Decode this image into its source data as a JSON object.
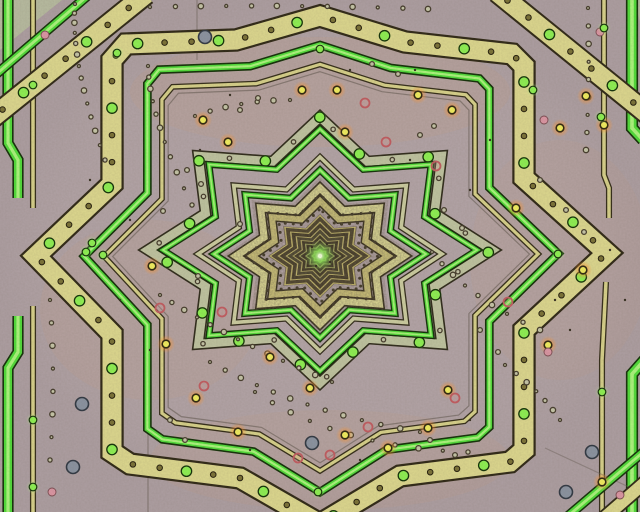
{
  "meta": {
    "title": "Kaleidoscopic fractal star pattern",
    "kind": "abstract-fractal-image"
  },
  "canvas": {
    "width": 640,
    "height": 512,
    "background": "#b2a3a6"
  },
  "palette": {
    "mauve": "#b2a3a6",
    "mauve_light": "#bcacae",
    "sage": "#b8bfa0",
    "band_yellow": "#ddd88e",
    "band_yellow_pale": "#e3e098",
    "band_yellow_deep": "#d2c87a",
    "green_bright": "#4fdd38",
    "green_core": "#abf77c",
    "green_edge": "#123007",
    "dark_edge": "#2e2715",
    "cluster_fill": "#70634f",
    "glow_center": "#f4ffe0",
    "glow_mid": "#8fe857",
    "halo_orange": "#ff9633",
    "dot_yellow": "#f3ef5e",
    "dot_green": "#8df251",
    "ring_red": "#c25b60",
    "pink": "#dc96a4",
    "grey_blue": "#8a93a1",
    "olive": "#7a7136"
  },
  "center": {
    "x": 320,
    "y": 258
  },
  "outer_path": [
    [
      320,
      16
    ],
    [
      405,
      42
    ],
    [
      512,
      54
    ],
    [
      524,
      66
    ],
    [
      524,
      178
    ],
    [
      607,
      253
    ],
    [
      524,
      330
    ],
    [
      524,
      450
    ],
    [
      510,
      462
    ],
    [
      400,
      476
    ],
    [
      320,
      524
    ],
    [
      240,
      478
    ],
    [
      130,
      464
    ],
    [
      112,
      452
    ],
    [
      112,
      334
    ],
    [
      36,
      256
    ],
    [
      112,
      184
    ],
    [
      112,
      60
    ],
    [
      126,
      44
    ],
    [
      236,
      40
    ]
  ],
  "stepped_rings": [
    {
      "name": "outer-yellow-band",
      "sx": 1,
      "sy": 1,
      "w": 19,
      "color": "#ddd88e",
      "edge": "#2e2715",
      "edgeW": 2.2,
      "band_dots": {
        "interval": 27,
        "pattern": [
          "olive",
          "olive",
          "greenband"
        ]
      }
    },
    {
      "name": "outer-thin-faint-line",
      "sx": 0.73,
      "sy": 0.77,
      "w": 1.2,
      "color": "#5f554c",
      "opacity": 0.55
    },
    {
      "name": "outer-thin-yellow-line",
      "sx": 0.76,
      "sy": 0.8,
      "w": 3.2,
      "color": "#d8d28a",
      "edge": "#332c18",
      "edgeW": 1.3
    },
    {
      "name": "outer-green-band",
      "sx": 0.83,
      "sy": 0.88,
      "w": 5.5,
      "color": "#4fdd38",
      "edge": "#123007",
      "edgeW": 1.6,
      "core": "#abf77c"
    }
  ],
  "octagram_rings": [
    {
      "name": "sage-band",
      "cy": 250,
      "rv": 133,
      "rh": 172,
      "w": 8.5,
      "color": "#bfc4a0",
      "edge": "#2e2a1a",
      "edgeW": 1.6,
      "band_dots": {
        "interval": 36,
        "pattern": [
          "smallring",
          "greenband"
        ]
      }
    },
    {
      "name": "mid-green-line",
      "cy": 250,
      "rv": 121,
      "rh": 157,
      "w": 4,
      "color": "#52df3a",
      "edge": "#123007",
      "edgeW": 1.4,
      "core": "#a8f478"
    },
    {
      "name": "pale-line",
      "cy": 254,
      "rv": 97,
      "rh": 122,
      "w": 3.6,
      "color": "#cccda0",
      "edge": "#332d1c",
      "edgeW": 1.3
    },
    {
      "name": "inner-green-line",
      "cy": 254,
      "rv": 84,
      "rh": 106,
      "w": 4.2,
      "color": "#4fdc38",
      "edge": "#123007",
      "edgeW": 1.4,
      "core": "#a8f478"
    },
    {
      "name": "inner-yellow-band-1",
      "cy": 256,
      "rv": 68,
      "rh": 84,
      "w": 7,
      "color": "#e3e098",
      "edge": "#2e2715",
      "edgeW": 1.6
    },
    {
      "name": "inner-yellow-band-2",
      "cy": 256,
      "rv": 55,
      "rh": 68,
      "w": 6,
      "color": "#d2c87a",
      "edge": "#2e2715",
      "edgeW": 1.5
    }
  ],
  "dotted_octagrams": [
    {
      "cy": 256,
      "rv": 61.5,
      "rh": 76,
      "interval": 9,
      "r": 1.5
    },
    {
      "cy": 256,
      "rv": 47,
      "rh": 58,
      "interval": 8,
      "r": 1.5
    }
  ],
  "cluster": {
    "cx": 320,
    "cy": 256,
    "underlay": {
      "rv": 42,
      "rh": 52,
      "fill": "#70634f"
    },
    "grain_clip": {
      "rv": 79,
      "rh": 97
    },
    "rings": [
      {
        "rv": 40,
        "w": 1.8,
        "c": "#cfc26e"
      },
      {
        "rv": 37,
        "w": 3.6,
        "c": "#473d26"
      },
      {
        "rv": 33.5,
        "w": 1.6,
        "c": "#c9bc6a"
      },
      {
        "rv": 30.5,
        "w": 3.4,
        "c": "#3f3622"
      },
      {
        "rv": 27,
        "w": 1.5,
        "c": "#cabe6e"
      },
      {
        "rv": 24.5,
        "w": 3,
        "c": "#46402a"
      },
      {
        "rv": 21.5,
        "w": 1.4,
        "c": "#b8ae62"
      },
      {
        "rv": 19,
        "w": 2.8,
        "c": "#3a321f"
      },
      {
        "rv": 16.5,
        "w": 1.3,
        "c": "#a3a85e"
      },
      {
        "rv": 14,
        "w": 2.6,
        "c": "#352e1d"
      },
      {
        "rv": 11.5,
        "w": 1.2,
        "c": "#97a458"
      },
      {
        "rv": 9,
        "w": 2.2,
        "c": "#30291a"
      },
      {
        "rv": 6.5,
        "w": 1.1,
        "c": "#86a24e"
      },
      {
        "rv": 4.2,
        "w": 1.8,
        "c": "#2b2517"
      }
    ]
  },
  "glow": {
    "x": 320,
    "y": 256,
    "r": 15
  },
  "corner_tris": [
    {
      "name": "tl-sage-corner",
      "pts": [
        [
          0,
          0
        ],
        [
          62,
          0
        ],
        [
          0,
          50
        ]
      ],
      "fill": "#b8bfa0",
      "opacity": 0.85
    },
    {
      "name": "tr-sage-corner",
      "pts": [
        [
          634,
          -2
        ],
        [
          642,
          -2
        ],
        [
          642,
          30
        ]
      ],
      "fill": "#b8bfa0",
      "opacity": 0.8
    }
  ],
  "corner_bands": [
    {
      "name": "tl-neighbor-green",
      "pts": [
        [
          -6,
          76
        ],
        [
          92,
          -8
        ]
      ],
      "w": 7,
      "color": "#4fdd38",
      "edge": "#123007",
      "edgeW": 1.5,
      "core": "#abf77c"
    },
    {
      "name": "tl-neighbor-yellow",
      "pts": [
        [
          -8,
          118
        ],
        [
          146,
          -6
        ]
      ],
      "w": 19,
      "color": "#ddd88e",
      "edge": "#2e2715",
      "edgeW": 2,
      "band_dots": {
        "interval": 27,
        "pattern": [
          "olive",
          "greenband",
          "olive"
        ]
      }
    },
    {
      "name": "tr-neighbor-yellow",
      "pts": [
        [
          497,
          -8
        ],
        [
          650,
          116
        ]
      ],
      "w": 19,
      "color": "#ddd88e",
      "edge": "#2e2715",
      "edgeW": 2,
      "band_dots": {
        "interval": 27,
        "pattern": [
          "olive",
          "olive",
          "greenband"
        ]
      }
    },
    {
      "name": "br-neighbor-green",
      "pts": [
        [
          568,
          516
        ],
        [
          648,
          448
        ]
      ],
      "w": 7,
      "color": "#4fdd38",
      "edge": "#123007",
      "edgeW": 1.5,
      "core": "#abf77c"
    },
    {
      "name": "br-neighbor-yellow",
      "pts": [
        [
          604,
          518
        ],
        [
          650,
          478
        ]
      ],
      "w": 12,
      "color": "#ddd88e",
      "edge": "#2e2715",
      "edgeW": 1.8
    }
  ],
  "edge_lines": [
    {
      "name": "left-green-band-top",
      "pts": [
        [
          8,
          -5
        ],
        [
          8,
          143
        ],
        [
          18,
          160
        ],
        [
          18,
          198
        ]
      ],
      "w": 8,
      "color": "#4fdd38",
      "edge": "#123007",
      "edgeW": 1.6,
      "core": "#abf77c"
    },
    {
      "name": "left-green-band-bottom",
      "pts": [
        [
          18,
          316
        ],
        [
          18,
          352
        ],
        [
          8,
          368
        ],
        [
          8,
          517
        ]
      ],
      "w": 8,
      "color": "#4fdd38",
      "edge": "#123007",
      "edgeW": 1.6,
      "core": "#abf77c"
    },
    {
      "name": "left-thin-yellow-top",
      "pts": [
        [
          33,
          -5
        ],
        [
          33,
          208
        ]
      ],
      "w": 3.5,
      "color": "#d8d28a",
      "edge": "#332c18",
      "edgeW": 1.3
    },
    {
      "name": "left-thin-yellow-bottom",
      "pts": [
        [
          33,
          306
        ],
        [
          33,
          517
        ]
      ],
      "w": 3.5,
      "color": "#d8d28a",
      "edge": "#332c18",
      "edgeW": 1.3
    },
    {
      "name": "right-thin-yellow-top",
      "pts": [
        [
          604,
          -5
        ],
        [
          604,
          175
        ],
        [
          609,
          188
        ],
        [
          609,
          218
        ]
      ],
      "w": 3.5,
      "color": "#d8d28a",
      "edge": "#332c18",
      "edgeW": 1.3
    },
    {
      "name": "right-thin-yellow-bottom",
      "pts": [
        [
          606,
          282
        ],
        [
          602,
          360
        ],
        [
          602,
          517
        ]
      ],
      "w": 3.5,
      "color": "#d8d28a",
      "edge": "#332c18",
      "edgeW": 1.3
    },
    {
      "name": "right-green-band-top",
      "pts": [
        [
          632,
          -5
        ],
        [
          632,
          128
        ],
        [
          643,
          140
        ]
      ],
      "w": 9,
      "color": "#4fdd38",
      "edge": "#123007",
      "edgeW": 1.6,
      "core": "#abf77c"
    },
    {
      "name": "right-green-band-bottom",
      "pts": [
        [
          647,
          357
        ],
        [
          632,
          374
        ],
        [
          632,
          517
        ]
      ],
      "w": 9,
      "color": "#4fdd38",
      "edge": "#123007",
      "edgeW": 1.6,
      "core": "#abf77c"
    },
    {
      "name": "faint-vertical-1",
      "pts": [
        [
          148,
          372
        ],
        [
          148,
          517
        ]
      ],
      "w": 1.4,
      "color": "#6b5f58",
      "opacity": 0.5
    },
    {
      "name": "faint-vertical-2",
      "pts": [
        [
          197,
          -2
        ],
        [
          197,
          60
        ]
      ],
      "w": 1.4,
      "color": "#6b5f58",
      "opacity": 0.45
    },
    {
      "name": "faint-scratch-br",
      "pts": [
        [
          545,
          448
        ],
        [
          644,
          494
        ]
      ],
      "w": 1.2,
      "color": "#6b5f58",
      "opacity": 0.45
    }
  ],
  "dot_arcs": [
    {
      "p": [
        [
          75,
          4
        ],
        [
          70,
          62
        ],
        [
          105,
          160
        ]
      ],
      "n": 14
    },
    {
      "p": [
        [
          148,
          66
        ],
        [
          150,
          120
        ],
        [
          192,
          205
        ]
      ],
      "n": 11
    },
    {
      "p": [
        [
          160,
          295
        ],
        [
          230,
          340
        ],
        [
          332,
          382
        ]
      ],
      "n": 13
    },
    {
      "p": [
        [
          210,
          362
        ],
        [
          300,
          412
        ],
        [
          420,
          432
        ]
      ],
      "n": 13
    },
    {
      "p": [
        [
          255,
          392
        ],
        [
          340,
          448
        ],
        [
          468,
          452
        ]
      ],
      "n": 11
    },
    {
      "p": [
        [
          432,
          252
        ],
        [
          470,
          300
        ],
        [
          540,
          330
        ]
      ],
      "n": 9
    },
    {
      "p": [
        [
          195,
          116
        ],
        [
          240,
          100
        ],
        [
          290,
          100
        ]
      ],
      "n": 7
    },
    {
      "p": [
        [
          588,
          8
        ],
        [
          590,
          80
        ],
        [
          586,
          150
        ]
      ],
      "n": 9
    },
    {
      "p": [
        [
          150,
          7
        ],
        [
          290,
          4
        ],
        [
          428,
          9
        ]
      ],
      "n": 12
    },
    {
      "p": [
        [
          50,
          300
        ],
        [
          56,
          380
        ],
        [
          50,
          460
        ]
      ],
      "n": 8
    },
    {
      "p": [
        [
          505,
          365
        ],
        [
          540,
          390
        ],
        [
          560,
          420
        ]
      ],
      "n": 7
    }
  ],
  "dots": {
    "glow_yellow": [
      [
        302,
        90
      ],
      [
        337,
        90
      ],
      [
        228,
        142
      ],
      [
        345,
        132
      ],
      [
        452,
        110
      ],
      [
        418,
        95
      ],
      [
        203,
        120
      ],
      [
        560,
        128
      ],
      [
        586,
        96
      ],
      [
        152,
        266
      ],
      [
        166,
        344
      ],
      [
        270,
        357
      ],
      [
        310,
        388
      ],
      [
        345,
        435
      ],
      [
        448,
        390
      ],
      [
        196,
        398
      ],
      [
        238,
        432
      ],
      [
        516,
        208
      ],
      [
        548,
        345
      ],
      [
        583,
        270
      ],
      [
        602,
        482
      ],
      [
        604,
        125
      ],
      [
        388,
        448
      ],
      [
        428,
        428
      ]
    ],
    "red_ring": [
      [
        365,
        103
      ],
      [
        386,
        142
      ],
      [
        222,
        312
      ],
      [
        204,
        386
      ],
      [
        368,
        427
      ],
      [
        455,
        398
      ],
      [
        436,
        166
      ],
      [
        508,
        302
      ],
      [
        160,
        308
      ],
      [
        298,
        458
      ],
      [
        330,
        455
      ]
    ],
    "pink": [
      [
        45,
        35
      ],
      [
        52,
        492
      ],
      [
        600,
        32
      ],
      [
        544,
        120
      ],
      [
        548,
        352
      ],
      [
        620,
        495
      ]
    ],
    "grey_blue": [
      [
        82,
        404
      ],
      [
        73,
        467
      ],
      [
        592,
        452
      ],
      [
        312,
        443
      ],
      [
        205,
        37
      ],
      [
        566,
        492
      ]
    ],
    "green_bright": [
      [
        33,
        85
      ],
      [
        33,
        420
      ],
      [
        33,
        487
      ],
      [
        117,
        53
      ],
      [
        604,
        28
      ],
      [
        601,
        117
      ],
      [
        320,
        49
      ],
      [
        86,
        252
      ],
      [
        558,
        254
      ],
      [
        318,
        492
      ],
      [
        92,
        243
      ],
      [
        103,
        255
      ],
      [
        602,
        392
      ],
      [
        533,
        90
      ]
    ],
    "small_ring": [
      [
        372,
        64
      ],
      [
        398,
        74
      ],
      [
        420,
        135
      ],
      [
        434,
        126
      ],
      [
        187,
        170
      ],
      [
        201,
        184
      ],
      [
        163,
        211
      ],
      [
        240,
        224
      ],
      [
        444,
        210
      ],
      [
        462,
        228
      ],
      [
        198,
        276
      ],
      [
        480,
        330
      ],
      [
        498,
        352
      ],
      [
        566,
        210
      ],
      [
        584,
        232
      ],
      [
        430,
        440
      ],
      [
        455,
        455
      ],
      [
        240,
        110
      ],
      [
        258,
        98
      ],
      [
        170,
        420
      ],
      [
        185,
        440
      ],
      [
        540,
        180
      ]
    ],
    "speck": [
      [
        350,
        70
      ],
      [
        230,
        95
      ],
      [
        410,
        160
      ],
      [
        470,
        190
      ],
      [
        200,
        150
      ],
      [
        130,
        220
      ],
      [
        90,
        180
      ],
      [
        555,
        300
      ],
      [
        570,
        330
      ],
      [
        470,
        420
      ],
      [
        360,
        460
      ],
      [
        250,
        450
      ],
      [
        150,
        350
      ],
      [
        120,
        300
      ],
      [
        490,
        140
      ],
      [
        610,
        250
      ],
      [
        625,
        300
      ],
      [
        415,
        70
      ],
      [
        312,
        247
      ],
      [
        330,
        262
      ],
      [
        316,
        266
      ],
      [
        327,
        244
      ]
    ]
  },
  "warm_patches": [
    {
      "x": 320,
      "y": 92,
      "rx": 190,
      "ry": 55,
      "opacity": 0.06
    },
    {
      "x": 150,
      "y": 310,
      "rx": 110,
      "ry": 90,
      "opacity": 0.05
    },
    {
      "x": 330,
      "y": 460,
      "rx": 180,
      "ry": 50,
      "opacity": 0.05
    },
    {
      "x": 560,
      "y": 260,
      "rx": 90,
      "ry": 120,
      "opacity": 0.04
    }
  ]
}
